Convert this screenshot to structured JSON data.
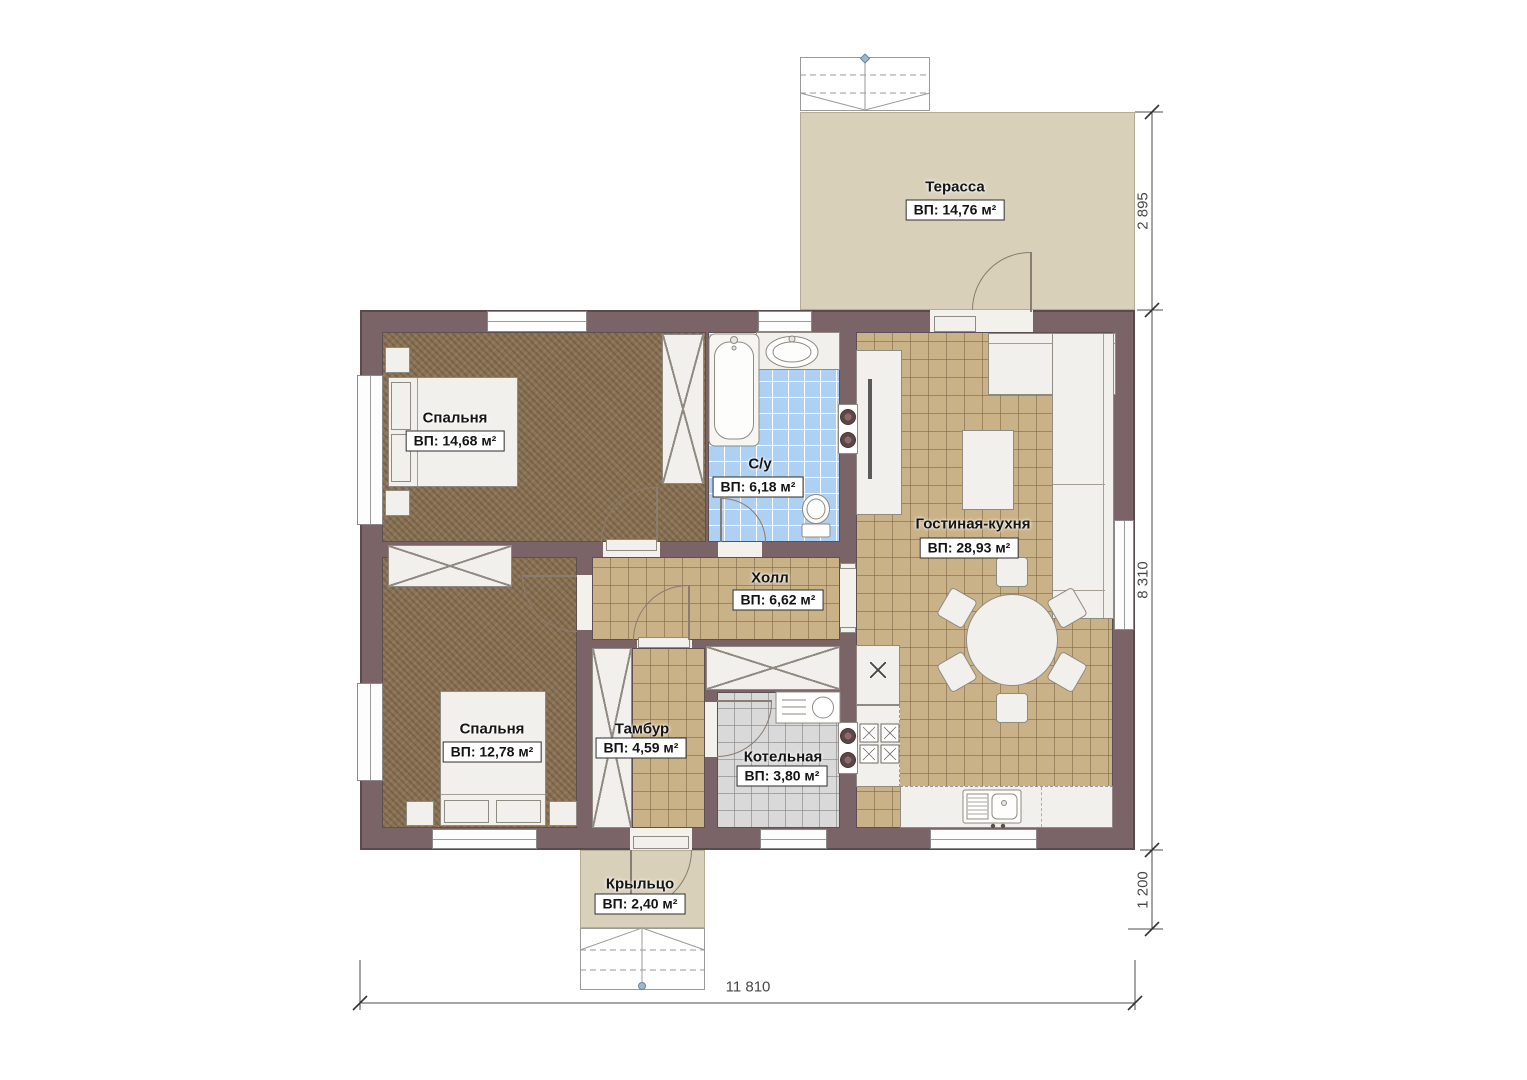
{
  "plan": {
    "rooms": [
      {
        "id": "terrace",
        "name": "Терасса",
        "area": "ВП: 14,76 м²"
      },
      {
        "id": "bedroom-1",
        "name": "Спальня",
        "area": "ВП: 14,68 м²"
      },
      {
        "id": "bathroom",
        "name": "С/у",
        "area": "ВП: 6,18 м²"
      },
      {
        "id": "living-kitchen",
        "name": "Гостиная-кухня",
        "area": "ВП: 28,93 м²"
      },
      {
        "id": "hall",
        "name": "Холл",
        "area": "ВП: 6,62 м²"
      },
      {
        "id": "bedroom-2",
        "name": "Спальня",
        "area": "ВП: 12,78 м²"
      },
      {
        "id": "vestibule",
        "name": "Тамбур",
        "area": "ВП: 4,59 м²"
      },
      {
        "id": "boiler-room",
        "name": "Котельная",
        "area": "ВП: 3,80 м²"
      },
      {
        "id": "porch",
        "name": "Крыльцо",
        "area": "ВП: 2,40 м²"
      }
    ],
    "dimensions": {
      "terrace_depth": "2 895",
      "house_depth": "8 310",
      "porch_depth": "1 200",
      "house_width": "11 810"
    },
    "colors": {
      "wall": "#7b6467",
      "carpet": "#8a7254",
      "tile_tan": "#c9b287",
      "tile_blue": "#aed0f2",
      "tile_grey": "#d9d9d9",
      "terrace": "#d9d0ba"
    }
  }
}
